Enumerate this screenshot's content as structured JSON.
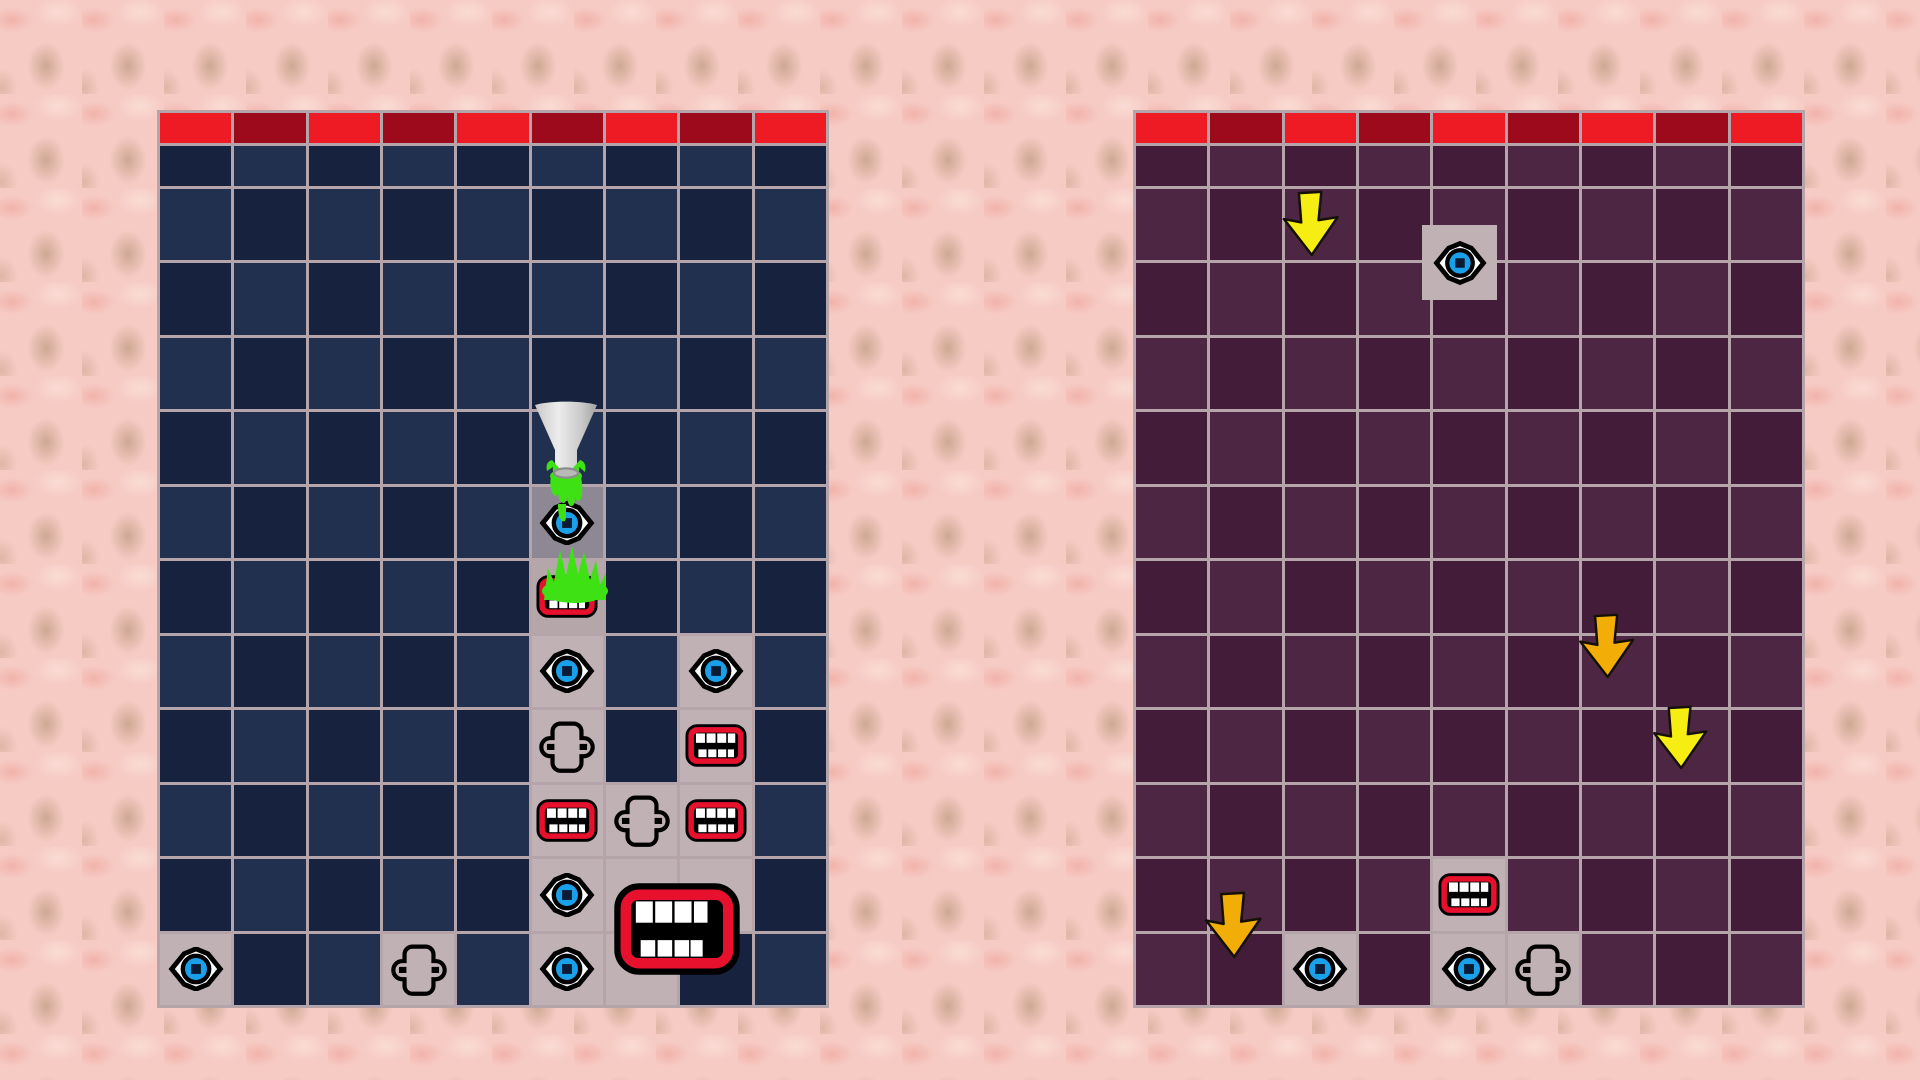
{
  "scene": {
    "width": 1920,
    "height": 1080,
    "palette": {
      "bg_base": "#f6cbc4",
      "bg_blob_tan": "#c7a28a",
      "bg_blob_rose": "#efa9a1",
      "bg_blob_light": "#fbe0d9",
      "grid_line": "#b5a5aa",
      "header_red_bright": "#ee1b24",
      "header_red_dark": "#9c0a1c",
      "left_cell_dark": "#16223e",
      "left_cell_light": "#21304f",
      "right_cell_dark": "#431c39",
      "right_cell_light": "#4d2643",
      "gray_cell": "#c0b1b5",
      "slimed_cell_dark": "#8e8894",
      "slimed_cell_mid": "#b5a6aa",
      "green_mid": "#215c30",
      "green_dark": "#12401f",
      "green_edge": "#c9babd",
      "slime_green": "#3ee214",
      "arrow_yellow": "#f6ee12",
      "arrow_amber": "#f2ae06",
      "eye_iris": "#1aa0e8",
      "eye_pupil": "#0b1b33",
      "mouth_red": "#e8112d",
      "tooth_white": "#ffffff",
      "outline_black": "#000000",
      "funnel_light": "#ececec",
      "funnel_mid": "#c9c9c9",
      "funnel_dark": "#a3a3a3",
      "funnel_rim": "#b9b9b9",
      "funnel_rim_edge": "#8d8d8d"
    },
    "left_board": {
      "name": "left-board",
      "x": 157,
      "y": 110,
      "w": 672,
      "h": 898,
      "cols": 9,
      "rows": 12,
      "theme": "left",
      "gray_cells": [
        [
          5,
          6
        ],
        [
          5,
          7
        ],
        [
          5,
          8
        ],
        [
          5,
          9
        ],
        [
          5,
          10
        ],
        [
          5,
          11
        ],
        [
          6,
          9
        ],
        [
          6,
          10
        ],
        [
          6,
          11
        ],
        [
          7,
          7
        ],
        [
          7,
          8
        ],
        [
          7,
          9
        ],
        [
          7,
          10
        ],
        [
          0,
          11
        ],
        [
          3,
          11
        ]
      ],
      "special_cells": [
        {
          "col": 5,
          "row": 5,
          "color_key": "slimed_cell_dark"
        },
        {
          "col": 5,
          "row": 6,
          "color_key": "slimed_cell_mid"
        }
      ],
      "items": [
        {
          "kind": "eye",
          "col": 5,
          "row": 5
        },
        {
          "kind": "mouth",
          "col": 5,
          "row": 6
        },
        {
          "kind": "eye",
          "col": 5,
          "row": 7
        },
        {
          "kind": "eye",
          "col": 7,
          "row": 7
        },
        {
          "kind": "nose",
          "col": 5,
          "row": 8
        },
        {
          "kind": "mouth",
          "col": 7,
          "row": 8
        },
        {
          "kind": "mouth",
          "col": 5,
          "row": 9
        },
        {
          "kind": "nose",
          "col": 6,
          "row": 9
        },
        {
          "kind": "mouth",
          "col": 7,
          "row": 9
        },
        {
          "kind": "eye",
          "col": 5,
          "row": 10
        },
        {
          "kind": "eye",
          "col": 5,
          "row": 11
        },
        {
          "kind": "eye",
          "col": 0,
          "row": 11
        },
        {
          "kind": "nose",
          "col": 3,
          "row": 11
        }
      ],
      "overlays": [
        {
          "kind": "big-mouth",
          "x": 455,
          "y": 773,
          "w": 130,
          "h": 92,
          "name": "big-mouth-icon",
          "interactable": "false"
        },
        {
          "kind": "splash",
          "x": 381,
          "y": 432,
          "w": 74,
          "h": 62,
          "name": "slime-splash-icon",
          "interactable": "false"
        },
        {
          "kind": "funnel",
          "x": 370,
          "y": 290,
          "w": 78,
          "h": 128,
          "name": "funnel-icon",
          "interactable": "true"
        }
      ]
    },
    "right_board": {
      "name": "right-board",
      "x": 1133,
      "y": 110,
      "w": 672,
      "h": 898,
      "cols": 9,
      "rows": 12,
      "theme": "right",
      "gray_cells": [
        [
          2,
          11
        ],
        [
          4,
          10
        ],
        [
          4,
          11
        ],
        [
          5,
          11
        ]
      ],
      "special_cells": [],
      "items": [
        {
          "kind": "eye",
          "col": 2,
          "row": 11
        },
        {
          "kind": "mouth",
          "col": 4,
          "row": 10
        },
        {
          "kind": "eye",
          "col": 4,
          "row": 11
        },
        {
          "kind": "nose",
          "col": 5,
          "row": 11
        }
      ],
      "overlays": [
        {
          "kind": "arrow",
          "color_key": "arrow_yellow",
          "x": 145,
          "y": 80,
          "w": 65,
          "h": 68,
          "name": "down-arrow-icon",
          "interactable": "true"
        },
        {
          "kind": "piece-eye",
          "x": 289,
          "y": 115,
          "w": 75,
          "h": 75,
          "name": "falling-eye-piece",
          "interactable": "true"
        },
        {
          "kind": "arrow",
          "color_key": "arrow_amber",
          "x": 442,
          "y": 503,
          "w": 63,
          "h": 67,
          "name": "down-arrow-icon",
          "interactable": "true"
        },
        {
          "kind": "arrow",
          "color_key": "arrow_yellow",
          "x": 517,
          "y": 595,
          "w": 60,
          "h": 66,
          "name": "down-arrow-icon",
          "interactable": "true"
        },
        {
          "kind": "arrow",
          "color_key": "arrow_amber",
          "x": 68,
          "y": 781,
          "w": 64,
          "h": 69,
          "name": "down-arrow-icon",
          "interactable": "true"
        }
      ]
    },
    "center": {
      "top_block": {
        "x": 863,
        "y": 111,
        "w": 224,
        "h": 150,
        "name": "center-top-block"
      },
      "left_column": {
        "x": 865,
        "y": 333,
        "w": 72,
        "h": 679,
        "name": "center-left-column"
      },
      "right_column": {
        "x": 1013,
        "y": 333,
        "w": 74,
        "h": 679,
        "name": "center-right-column"
      }
    }
  }
}
